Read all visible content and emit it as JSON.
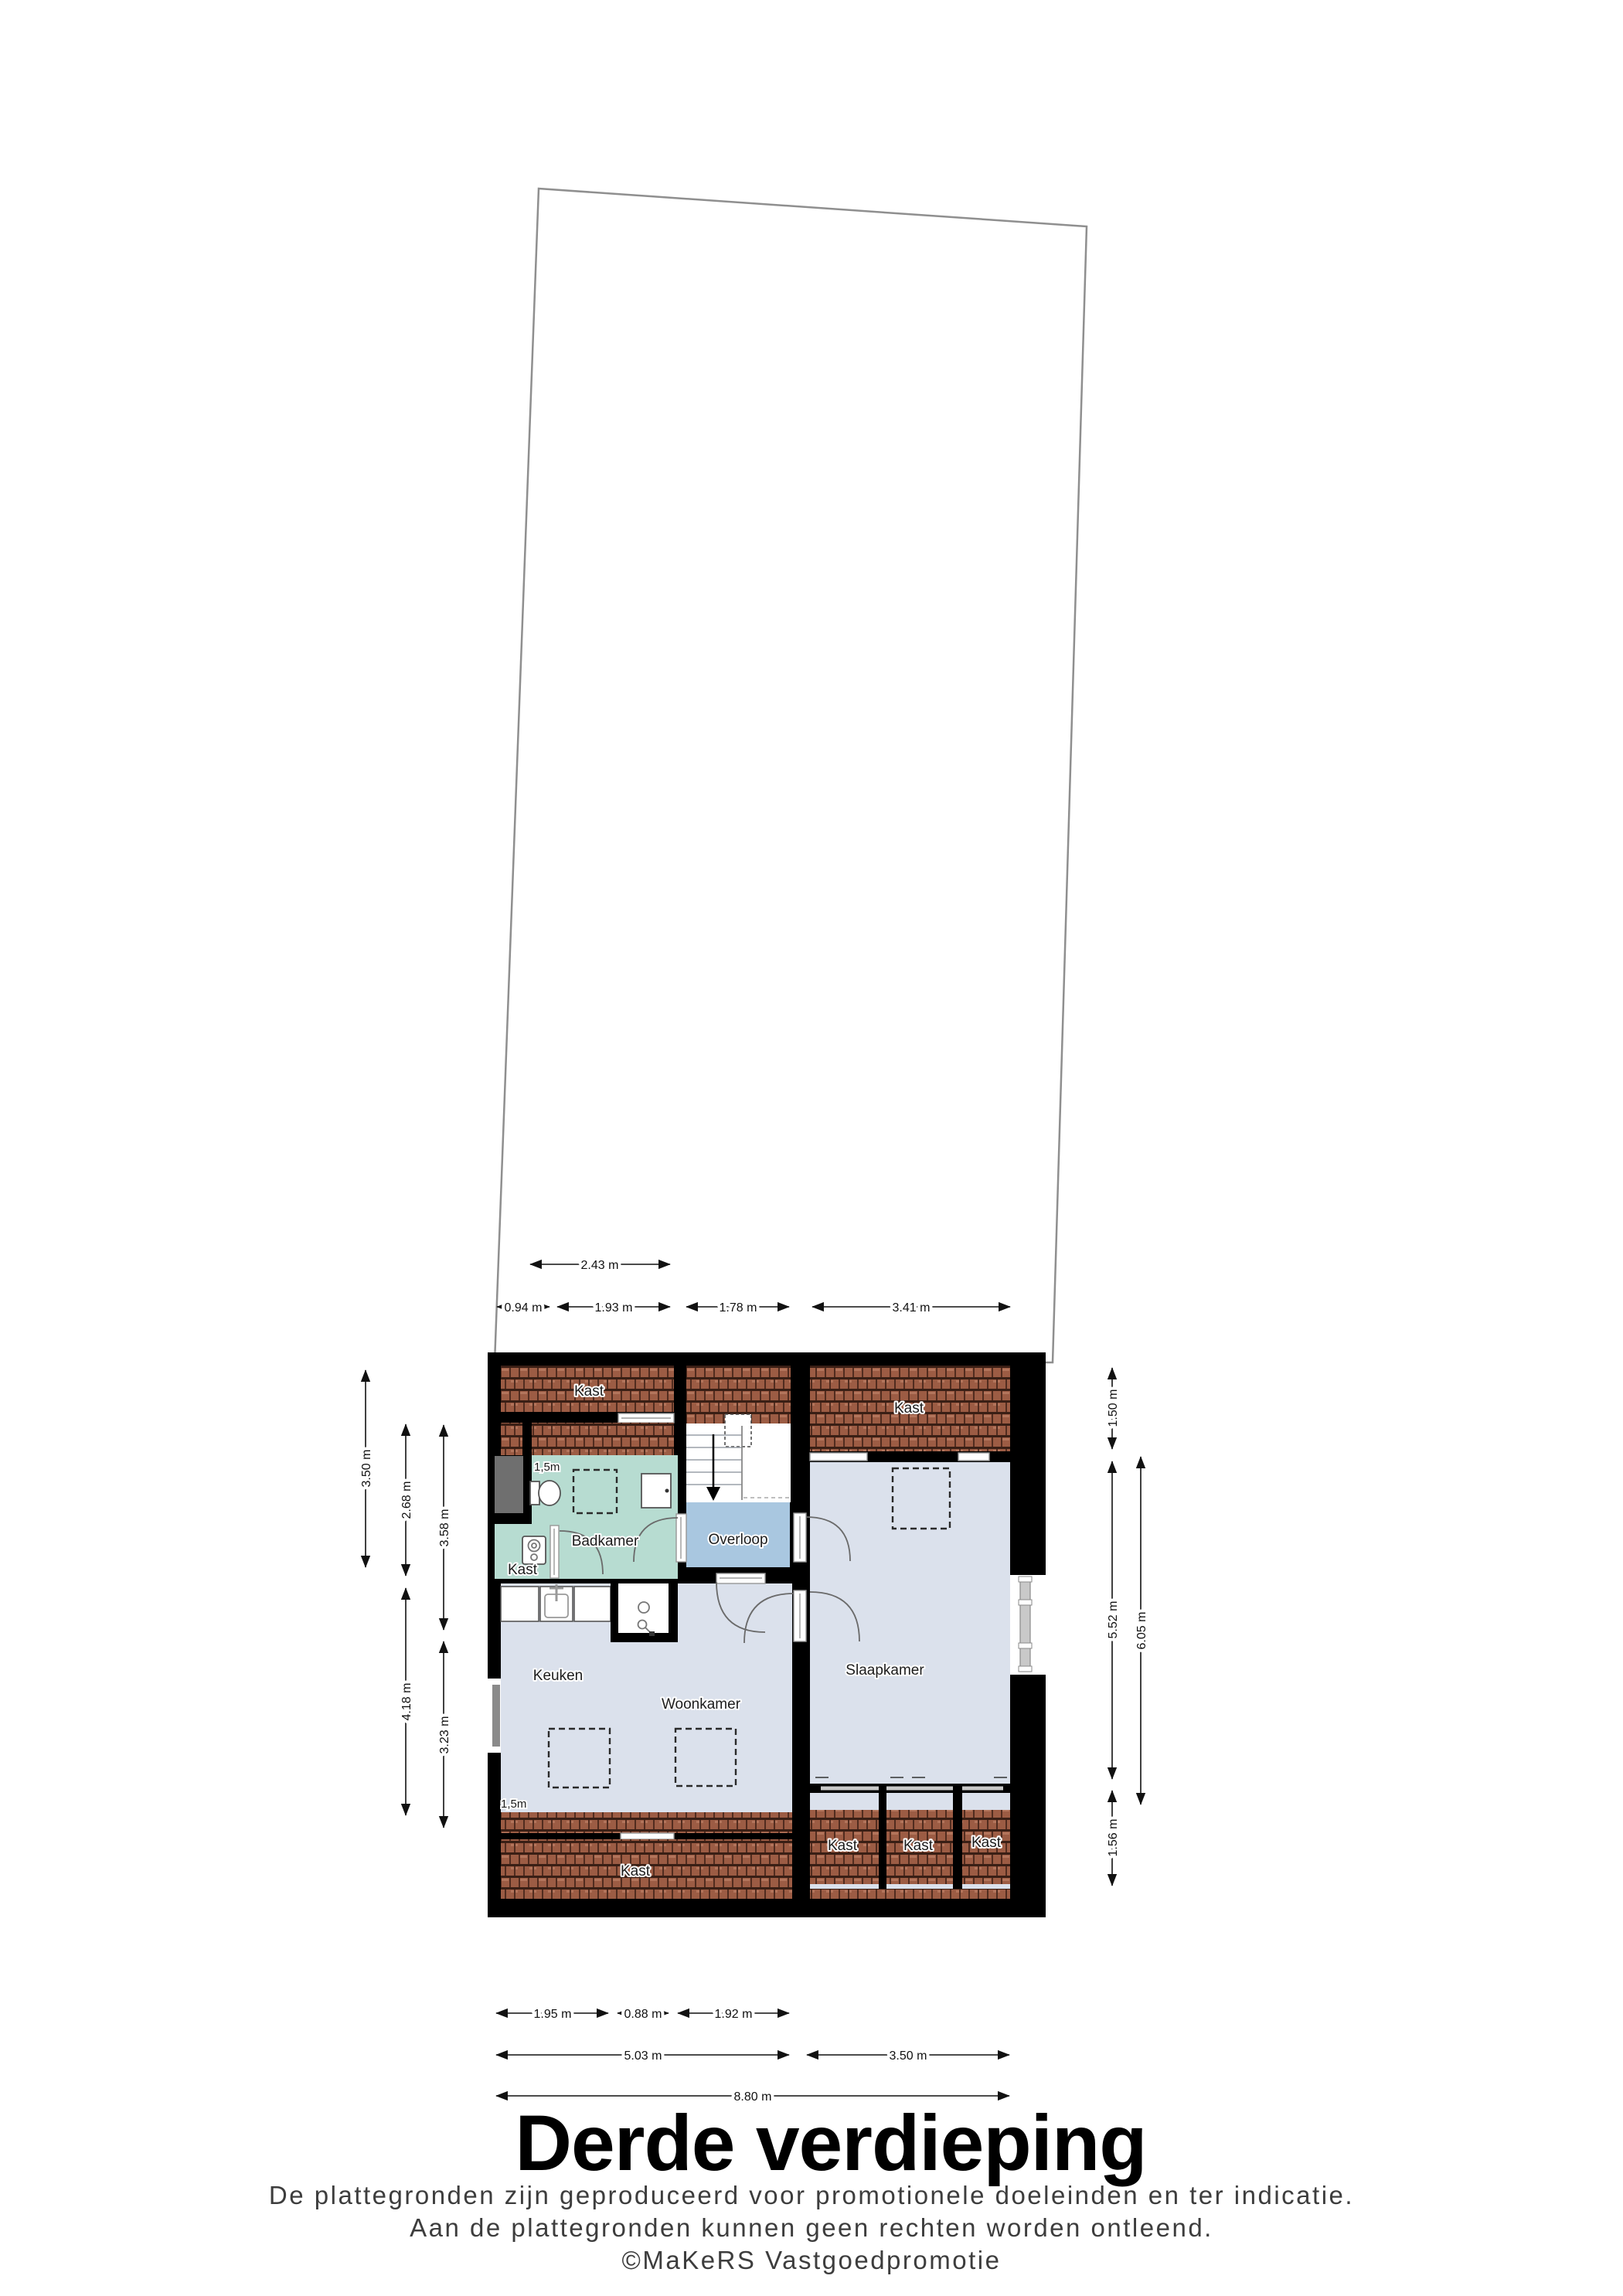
{
  "title": "Derde verdieping",
  "footer": {
    "line1": "De plattegronden zijn geproduceerd voor promotionele doeleinden en ter indicatie.",
    "line2": "Aan de plattegronden kunnen geen rechten worden ontleend.",
    "line3": "©MaKeRS Vastgoedpromotie"
  },
  "rooms": {
    "badkamer": "Badkamer",
    "overloop": "Overloop",
    "keuken": "Keuken",
    "woonkamer": "Woonkamer",
    "slaapkamer": "Slaapkamer"
  },
  "closet_labels": {
    "attic_top_left": "Kast",
    "attic_top_right": "Kast",
    "boiler_closet": "Kast",
    "attic_bottom_left": "Kast",
    "bedroom_closet_1": "Kast",
    "bedroom_closet_2": "Kast",
    "bedroom_closet_3": "Kast"
  },
  "height_markers": {
    "badkamer": "1,5m",
    "woonkamer": "1,5m"
  },
  "dimensions": {
    "top": {
      "d243": "2.43 m",
      "d094": "0.94 m",
      "d193": "1.93 m",
      "d178": "1.78 m",
      "d341": "3.41 m"
    },
    "bottom": {
      "d195": "1.95 m",
      "d088": "0.88 m",
      "d192": "1.92 m",
      "d503": "5.03 m",
      "d350": "3.50 m",
      "d880": "8.80 m"
    },
    "left": {
      "d350": "3.50 m",
      "d268": "2.68 m",
      "d418": "4.18 m",
      "d358": "3.58 m",
      "d323": "3.23 m"
    },
    "right": {
      "d150": "1.50 m",
      "d552": "5.52 m",
      "d156": "1.56 m",
      "d605": "6.05 m"
    }
  },
  "colors": {
    "wall": "#000000",
    "room": "#dbe1ec",
    "landing": "#a9c7e0",
    "bathroom": "#b7dcd1",
    "roof_tile": "#9c5c44",
    "chimney": "#6f6f6f"
  }
}
